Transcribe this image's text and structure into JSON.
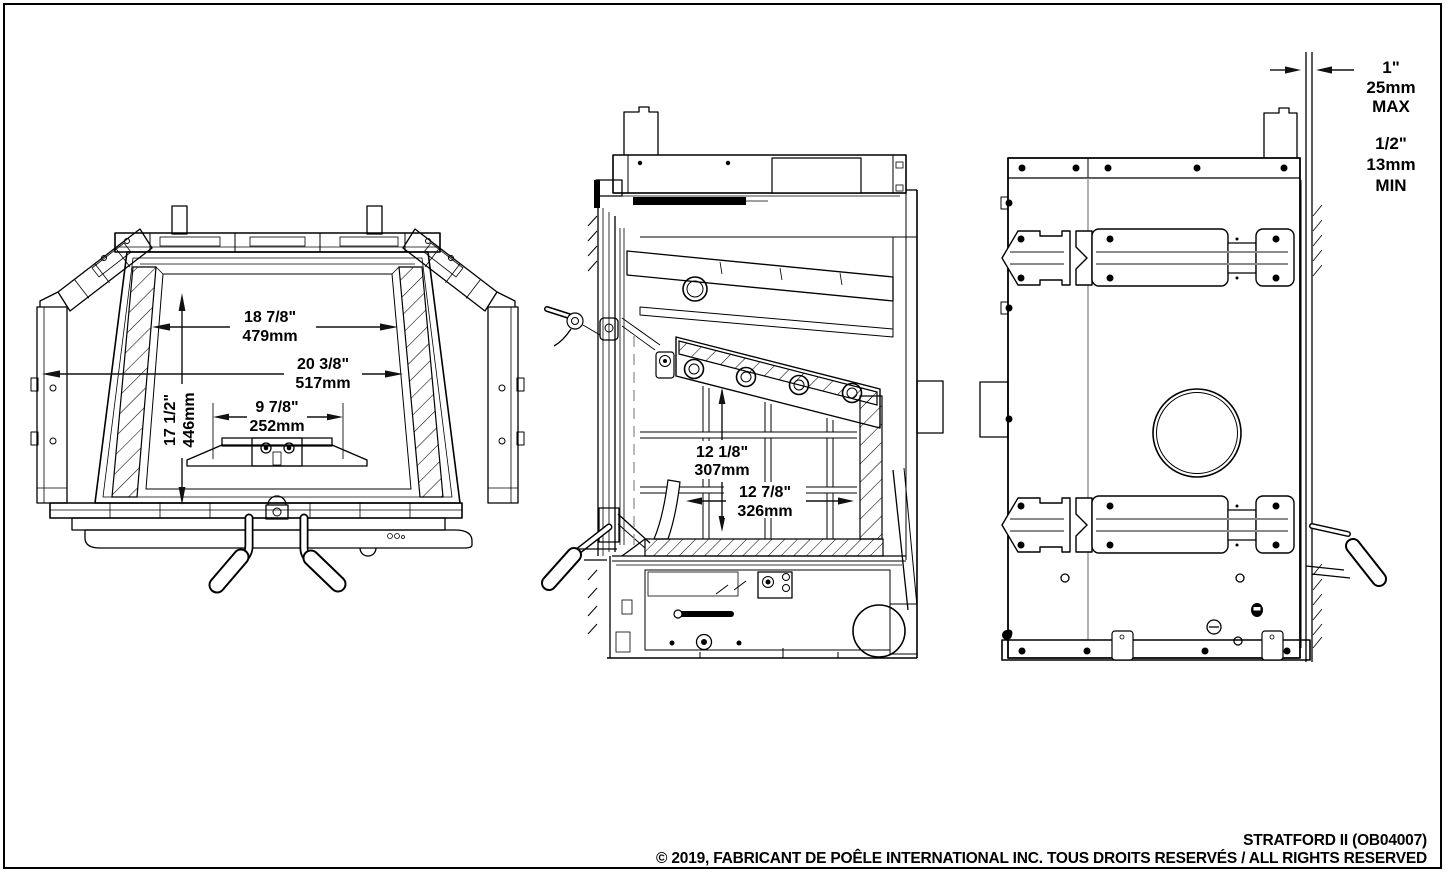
{
  "dimensions": {
    "front": {
      "glass_width_in": "18 7/8\"",
      "glass_width_mm": "479mm",
      "opening_width_in": "20 3/8\"",
      "opening_width_mm": "517mm",
      "center_width_in": "9 7/8\"",
      "center_width_mm": "252mm",
      "height_in": "17 1/2\"",
      "height_mm": "446mm"
    },
    "side": {
      "firebox_height_in": "12 1/8\"",
      "firebox_height_mm": "307mm",
      "firebox_depth_in": "12 7/8\"",
      "firebox_depth_mm": "326mm"
    },
    "clearance": {
      "max_in": "1\"",
      "max_mm": "25mm",
      "max_label": "MAX",
      "min_in": "1/2\"",
      "min_mm": "13mm",
      "min_label": "MIN"
    }
  },
  "footer": {
    "model": "STRATFORD II (OB04007)",
    "copyright": "© 2019, FABRICANT DE POÊLE INTERNATIONAL INC. TOUS DROITS RESERVÉS / ALL RIGHTS RESERVED"
  }
}
